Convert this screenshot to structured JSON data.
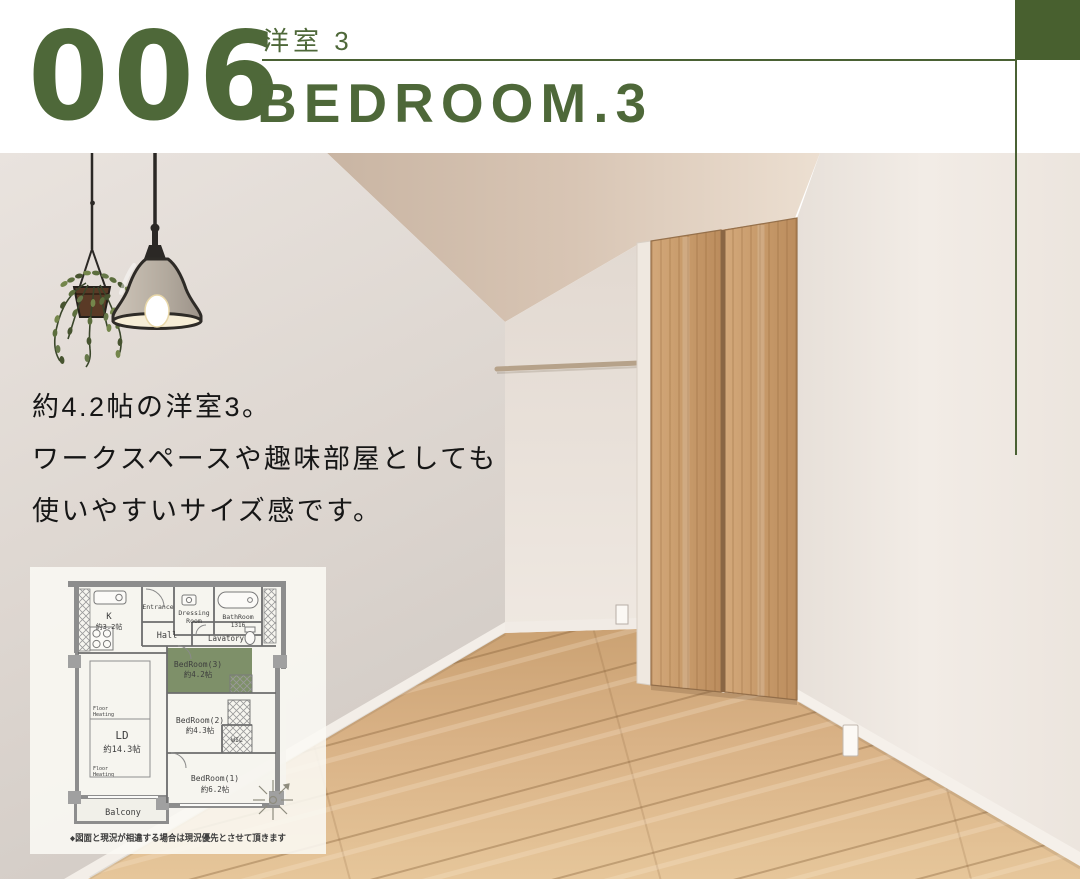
{
  "colors": {
    "brand_green": "#4e6839",
    "accent_line_green": "#4a6134",
    "corner_square_green": "#48602f",
    "plan_highlight_green": "#7e9069"
  },
  "header": {
    "number": "006",
    "room_label_jp": "洋室 3",
    "room_title_en": "BEDROOM.3"
  },
  "photo_overlay": {
    "description_lines": [
      "約4.2帖の洋室3。",
      "ワークスペースや趣味部屋としても",
      "使いやすいサイズ感です。"
    ]
  },
  "floorplan": {
    "caption": "◆図面と現況が相違する場合は現況優先とさせて頂きます",
    "labels": {
      "k_name": "K",
      "k_size": "約3.2帖",
      "entrance": "Entrance",
      "dressing_line1": "Dressing",
      "dressing_line2": "Room",
      "bath_line1": "BathRoom",
      "bath_line2": "1316",
      "hall": "Hall",
      "lavatory": "Lavatory",
      "bedroom3_name": "BedRoom(3)",
      "bedroom3_size": "約4.2帖",
      "ld_name": "LD",
      "ld_size": "約14.3帖",
      "floor_heating_line1": "Floor",
      "floor_heating_line2": "Heating",
      "bedroom2_name": "BedRoom(2)",
      "bedroom2_size": "約4.3帖",
      "wic": "WIC",
      "bedroom1_name": "BedRoom(1)",
      "bedroom1_size": "約6.2帖",
      "balcony": "Balcony"
    }
  }
}
